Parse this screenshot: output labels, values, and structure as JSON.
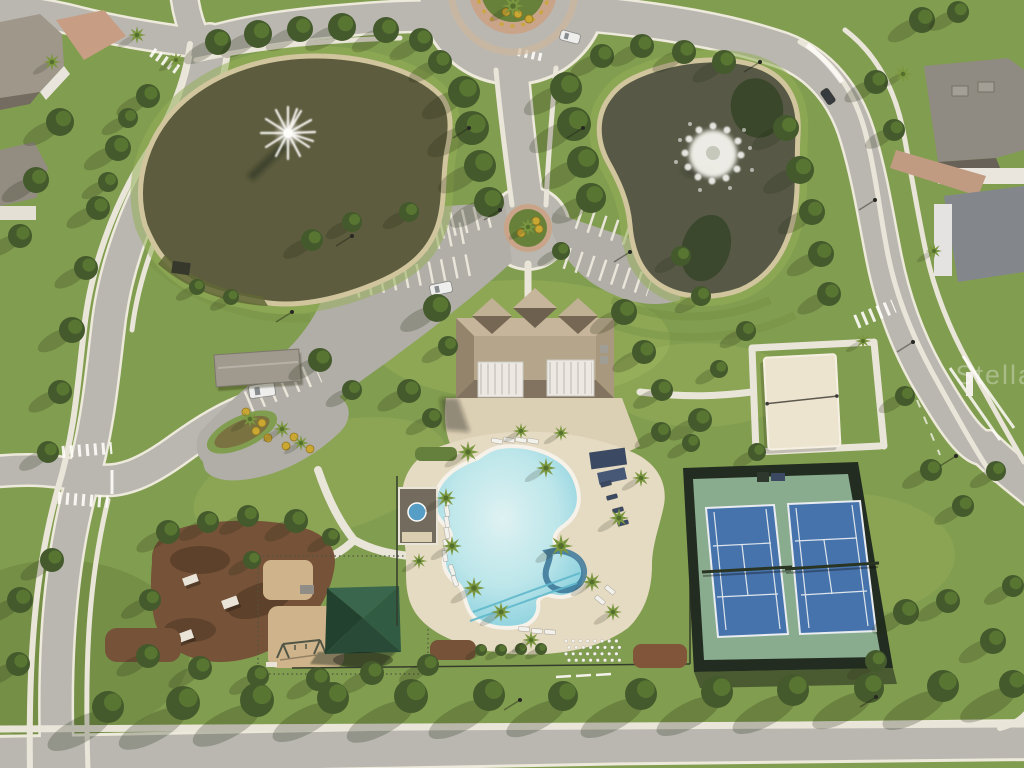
{
  "scene": {
    "description": "aerial-drone-photo-community-amenity-center",
    "features": [
      "pond-with-fountain-west",
      "pond-with-fountain-east",
      "clubhouse",
      "resort-pool",
      "tennis-courts",
      "sand-volleyball-court",
      "playground",
      "dog-park",
      "pavilion",
      "parking-lots",
      "roundabout",
      "residential-streets"
    ]
  },
  "watermark": {
    "text": "Stellar"
  },
  "palette": {
    "grass": "#7b9a4b",
    "grassLight": "#b8cc6e",
    "water": "#55563a",
    "waterRight": "#4e5342",
    "bank": "#cfc49e",
    "road": "#b7b6b2",
    "roadDark": "#adaca8",
    "sidewalk": "#e9e6dd",
    "paver": "#dbd0b6",
    "deck": "#e4dbc5",
    "poolEdge": "#6ec7db",
    "coping": "#f6f4ee",
    "roofTan": "#b2a48b",
    "roofShadow": "#7b6e5c",
    "awning": "#eceae6",
    "fence": "#17231a",
    "courtGreen": "#83aa8f",
    "courtBlue": "#3e6eae",
    "courtLine": "#dce6ef",
    "sand": "#ece5d2",
    "mulch": "#6e4b33",
    "mulchPlay": "#cdb38b",
    "pavilionGreen": "#2f6049",
    "treeDark": "#3a5426",
    "treeMid": "#55752f",
    "palmGreen": "#74943c",
    "brick": "#c49a82",
    "houseRoof": "#8b8781",
    "houseRoofBlue": "#7d838c",
    "navy": "#31435f",
    "carWhite": "#eef0f2",
    "carDark": "#2e3338",
    "yellowShrub": "#c8a42e",
    "shadow": "rgba(25,35,15,0.45)"
  },
  "trees": {
    "canopy": [
      [
        218,
        42,
        13
      ],
      [
        258,
        34,
        14
      ],
      [
        300,
        29,
        13
      ],
      [
        342,
        27,
        14
      ],
      [
        386,
        30,
        13
      ],
      [
        421,
        40,
        12
      ],
      [
        148,
        96,
        12
      ],
      [
        118,
        148,
        13
      ],
      [
        98,
        208,
        12
      ],
      [
        86,
        268,
        12
      ],
      [
        72,
        330,
        13
      ],
      [
        60,
        392,
        12
      ],
      [
        48,
        452,
        11
      ],
      [
        128,
        118,
        10
      ],
      [
        108,
        182,
        10
      ],
      [
        464,
        92,
        16
      ],
      [
        472,
        128,
        17
      ],
      [
        480,
        166,
        16
      ],
      [
        489,
        202,
        15
      ],
      [
        566,
        88,
        16
      ],
      [
        574,
        124,
        17
      ],
      [
        583,
        162,
        16
      ],
      [
        591,
        198,
        15
      ],
      [
        440,
        62,
        12
      ],
      [
        602,
        56,
        12
      ],
      [
        642,
        46,
        12
      ],
      [
        684,
        52,
        12
      ],
      [
        724,
        62,
        12
      ],
      [
        786,
        128,
        13
      ],
      [
        800,
        170,
        14
      ],
      [
        812,
        212,
        13
      ],
      [
        821,
        254,
        13
      ],
      [
        829,
        294,
        12
      ],
      [
        876,
        82,
        12
      ],
      [
        894,
        130,
        11
      ],
      [
        437,
        308,
        14
      ],
      [
        448,
        346,
        10
      ],
      [
        624,
        312,
        13
      ],
      [
        644,
        352,
        12
      ],
      [
        662,
        390,
        11
      ],
      [
        700,
        420,
        12
      ],
      [
        661,
        432,
        10
      ],
      [
        352,
        222,
        10
      ],
      [
        312,
        240,
        11
      ],
      [
        409,
        212,
        10
      ],
      [
        320,
        360,
        12
      ],
      [
        352,
        390,
        10
      ],
      [
        409,
        391,
        12
      ],
      [
        432,
        418,
        10
      ],
      [
        168,
        532,
        12
      ],
      [
        208,
        522,
        11
      ],
      [
        248,
        516,
        11
      ],
      [
        296,
        521,
        12
      ],
      [
        150,
        600,
        11
      ],
      [
        148,
        656,
        12
      ],
      [
        200,
        668,
        12
      ],
      [
        258,
        676,
        11
      ],
      [
        318,
        679,
        12
      ],
      [
        372,
        673,
        12
      ],
      [
        428,
        665,
        11
      ],
      [
        252,
        560,
        9
      ],
      [
        331,
        537,
        9
      ],
      [
        906,
        612,
        13
      ],
      [
        948,
        601,
        12
      ],
      [
        993,
        641,
        13
      ],
      [
        1013,
        586,
        11
      ],
      [
        876,
        661,
        11
      ],
      [
        905,
        396,
        10
      ],
      [
        931,
        470,
        11
      ],
      [
        963,
        506,
        11
      ],
      [
        996,
        471,
        10
      ],
      [
        746,
        331,
        10
      ],
      [
        719,
        369,
        9
      ],
      [
        757,
        452,
        9
      ],
      [
        691,
        443,
        9
      ],
      [
        197,
        287,
        8
      ],
      [
        231,
        297,
        8
      ],
      [
        561,
        251,
        9
      ],
      [
        681,
        256,
        10
      ],
      [
        701,
        296,
        10
      ],
      [
        481,
        650,
        6
      ],
      [
        501,
        650,
        6
      ],
      [
        521,
        649,
        6
      ],
      [
        541,
        649,
        6
      ],
      [
        60,
        122,
        14
      ],
      [
        36,
        180,
        13
      ],
      [
        20,
        236,
        12
      ],
      [
        52,
        560,
        12
      ],
      [
        20,
        600,
        13
      ],
      [
        18,
        664,
        12
      ],
      [
        922,
        20,
        13
      ],
      [
        958,
        12,
        11
      ]
    ],
    "street": [
      [
        108,
        707,
        16
      ],
      [
        183,
        703,
        17
      ],
      [
        257,
        700,
        17
      ],
      [
        333,
        698,
        16
      ],
      [
        411,
        696,
        17
      ],
      [
        489,
        695,
        16
      ],
      [
        563,
        696,
        15
      ],
      [
        641,
        694,
        16
      ],
      [
        717,
        692,
        16
      ],
      [
        793,
        690,
        16
      ],
      [
        869,
        688,
        15
      ],
      [
        943,
        686,
        16
      ],
      [
        1013,
        684,
        14
      ]
    ],
    "palm": [
      [
        468,
        452,
        11
      ],
      [
        446,
        498,
        10
      ],
      [
        452,
        546,
        10
      ],
      [
        474,
        588,
        11
      ],
      [
        501,
        612,
        10
      ],
      [
        546,
        468,
        10
      ],
      [
        561,
        546,
        12
      ],
      [
        592,
        582,
        10
      ],
      [
        619,
        518,
        10
      ],
      [
        641,
        478,
        9
      ],
      [
        613,
        612,
        9
      ],
      [
        531,
        640,
        9
      ],
      [
        250,
        419,
        9
      ],
      [
        282,
        429,
        9
      ],
      [
        301,
        443,
        8
      ],
      [
        528,
        227,
        9
      ],
      [
        513,
        6,
        11
      ],
      [
        903,
        74,
        9
      ],
      [
        934,
        251,
        8
      ],
      [
        52,
        62,
        9
      ],
      [
        521,
        431,
        8
      ],
      [
        561,
        433,
        8
      ],
      [
        863,
        341,
        8
      ],
      [
        419,
        561,
        8
      ],
      [
        137,
        35,
        9
      ],
      [
        176,
        60,
        8
      ]
    ]
  },
  "shrubs": [
    [
      256,
      431
    ],
    [
      268,
      438
    ],
    [
      286,
      446
    ],
    [
      262,
      423
    ],
    [
      294,
      437
    ],
    [
      518,
      14
    ],
    [
      529,
      19
    ],
    [
      506,
      12
    ],
    [
      539,
      229
    ],
    [
      521,
      233
    ],
    [
      536,
      221
    ],
    [
      246,
      412
    ],
    [
      310,
      449
    ]
  ],
  "lightPoles": [
    [
      469,
      128
    ],
    [
      583,
      128
    ],
    [
      500,
      210
    ],
    [
      630,
      252
    ],
    [
      875,
      200
    ],
    [
      913,
      342
    ],
    [
      956,
      456
    ],
    [
      876,
      697
    ],
    [
      520,
      700
    ],
    [
      352,
      236
    ],
    [
      292,
      312
    ],
    [
      760,
      62
    ]
  ],
  "cars": [
    {
      "x": 430,
      "y": 283,
      "w": 22,
      "h": 11,
      "rot": -12,
      "color": "carWhite"
    },
    {
      "x": 249,
      "y": 384,
      "w": 26,
      "h": 13,
      "rot": -8,
      "color": "carWhite"
    },
    {
      "x": 560,
      "y": 32,
      "w": 20,
      "h": 10,
      "rot": 15,
      "color": "carWhite"
    },
    {
      "x": 820,
      "y": 92,
      "w": 16,
      "h": 9,
      "rot": 55,
      "color": "carDark"
    }
  ],
  "loungers": [
    [
      447,
      500,
      80,
      "w"
    ],
    [
      447,
      511,
      80,
      "w"
    ],
    [
      447,
      522,
      80,
      "w"
    ],
    [
      447,
      533,
      80,
      "w"
    ],
    [
      446,
      545,
      80,
      "w"
    ],
    [
      445,
      556,
      80,
      "w"
    ],
    [
      452,
      570,
      70,
      "w"
    ],
    [
      455,
      581,
      70,
      "w"
    ],
    [
      497,
      441,
      10,
      "w"
    ],
    [
      509,
      440,
      10,
      "w"
    ],
    [
      521,
      440,
      10,
      "w"
    ],
    [
      533,
      441,
      10,
      "w"
    ],
    [
      606,
      484,
      -15,
      "n"
    ],
    [
      612,
      497,
      -15,
      "n"
    ],
    [
      618,
      510,
      -15,
      "n"
    ],
    [
      623,
      523,
      -15,
      "n"
    ],
    [
      524,
      629,
      5,
      "w"
    ],
    [
      537,
      631,
      5,
      "w"
    ],
    [
      550,
      632,
      5,
      "w"
    ],
    [
      600,
      600,
      40,
      "w"
    ],
    [
      610,
      590,
      40,
      "w"
    ]
  ],
  "stackedChairs": {
    "x": 566,
    "y": 641,
    "cols": 8,
    "rows": 4,
    "dx": 7.2,
    "dy": 6.4
  }
}
